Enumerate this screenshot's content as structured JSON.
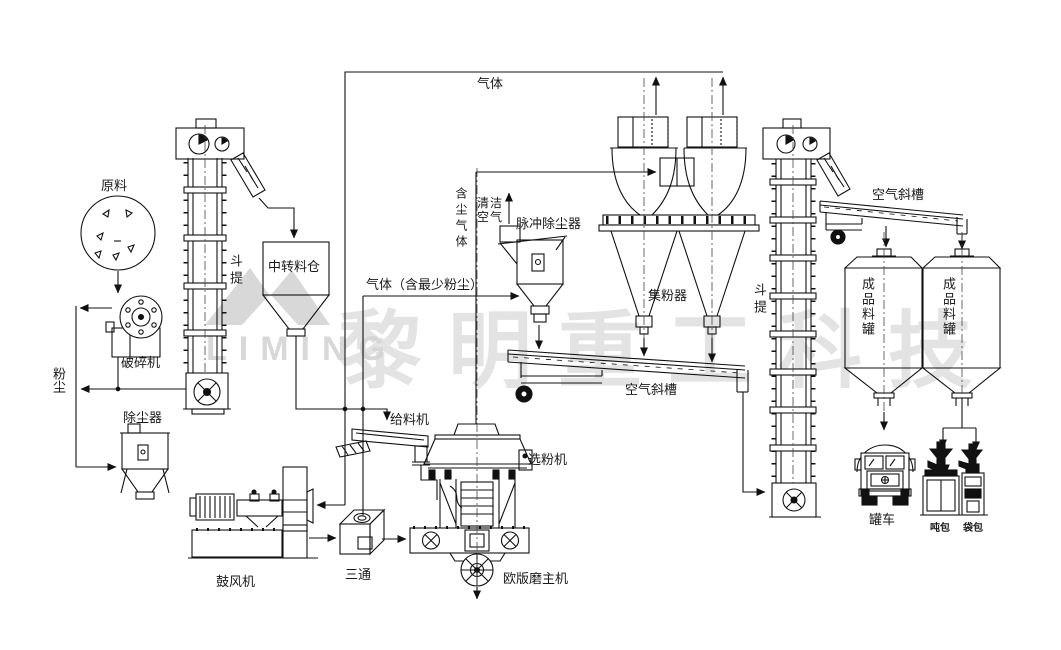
{
  "diagram": {
    "labels": {
      "raw_material": "原料",
      "crusher": "破碎机",
      "dust": "粉尘",
      "dust_collector": "除尘器",
      "bucket_elevator_left": "斗提",
      "transfer_silo": "中转料仓",
      "gas": "气体",
      "dusty_gas": "含尘气体",
      "clean_air": "清洁空气",
      "pulse_dust_collector": "脉冲除尘器",
      "gas_minimal_dust": "气体（含最少粉尘）",
      "powder_collector": "集粉器",
      "air_chute_center": "空气斜槽",
      "bucket_elevator_right": "斗提",
      "air_chute_right": "空气斜槽",
      "product_silo_left": "成品料罐",
      "product_silo_right": "成品料罐",
      "tank_truck": "罐车",
      "ton_bag": "吨包",
      "bag_pack": "袋包",
      "feeder": "给料机",
      "classifier": "选粉机",
      "mill_main": "欧版磨主机",
      "tee": "三通",
      "blower": "鼓风机"
    },
    "watermark": {
      "brand_text": "黎明重工科技",
      "logo_text": "LIMING"
    },
    "colors": {
      "line": "#1a1a1a",
      "background": "#ffffff",
      "watermark": "#cdcdcd"
    }
  }
}
